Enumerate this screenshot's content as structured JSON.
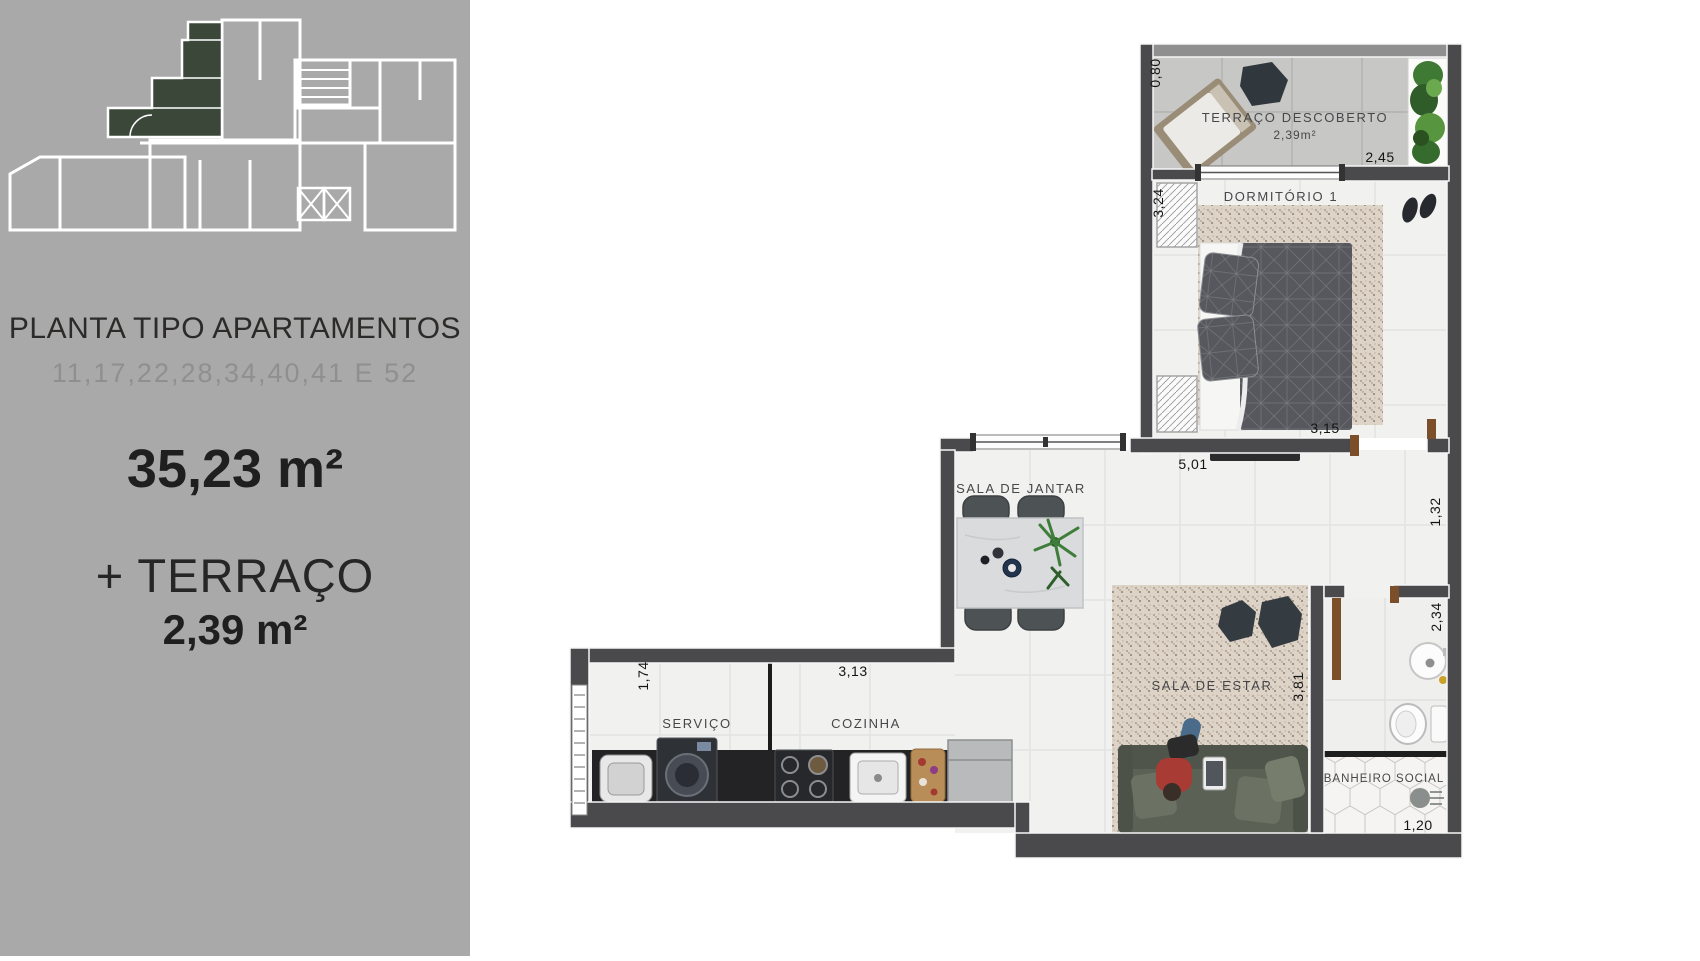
{
  "sidebar": {
    "title": "PLANTA TIPO APARTAMENTOS",
    "subtitle": "11,17,22,28,34,40,41 E 52",
    "main_area": "35,23 m²",
    "terrace_plus": "+ TERRAÇO",
    "terrace_area": "2,39 m²",
    "colors": {
      "background": "#a9a9a9",
      "keyplan_lines": "#ffffff",
      "highlight_unit": "#3b4839",
      "title_text": "#2c2b29",
      "subtitle_text": "#8f8f8f"
    }
  },
  "floorplan": {
    "rooms": {
      "terrace": {
        "label": "TERRAÇO DESCOBERTO",
        "area": "2,39m²"
      },
      "bedroom": {
        "label": "DORMITÓRIO 1"
      },
      "dining": {
        "label": "SALA DE JANTAR"
      },
      "living": {
        "label": "SALA DE ESTAR"
      },
      "laundry": {
        "label": "SERVIÇO"
      },
      "kitchen": {
        "label": "COZINHA"
      },
      "bathroom": {
        "label": "BANHEIRO SOCIAL"
      }
    },
    "dimensions": {
      "terrace_depth": "0,80",
      "terrace_width": "2,45",
      "bedroom_side": "3,24",
      "bedroom_width": "3,15",
      "living_width": "5,01",
      "hall_side": "1,32",
      "bath_side": "2,34",
      "living_side": "3,81",
      "laundry_depth": "1,74",
      "kitchen_width": "3,13",
      "bath_width": "1,20"
    },
    "colors": {
      "walls": "#4a4a4c",
      "parapet": "#8f8f8f",
      "floor_tile": "#f1f1f0",
      "terrace_floor": "#c7c7c6",
      "rug": "#ddd3c7",
      "counter": "#232326",
      "door_wood": "#7a4f2a",
      "sofa": "#5b6155",
      "bed_duvet": "#56585d",
      "label_text": "#47474a"
    }
  }
}
